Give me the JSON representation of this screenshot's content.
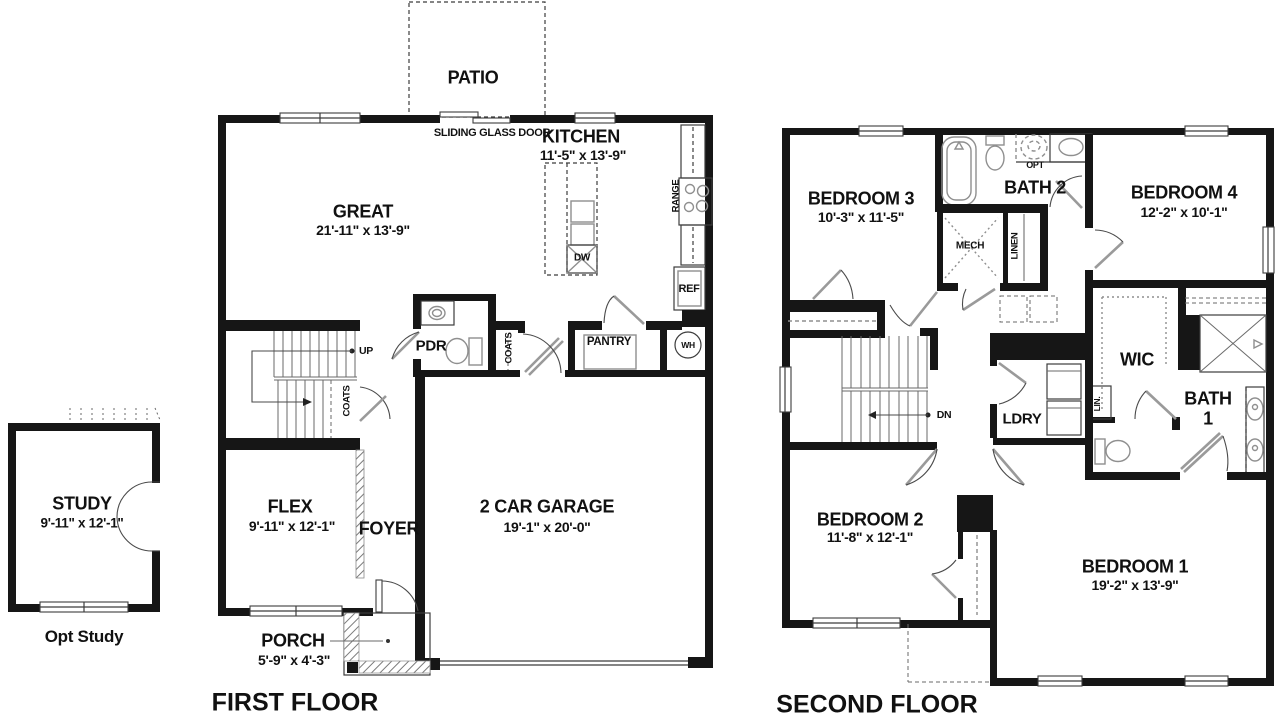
{
  "study": {
    "name": "STUDY",
    "dims": "9'-11\" x 12'-1\"",
    "caption": "Opt Study"
  },
  "first_floor": {
    "title": "FIRST FLOOR",
    "patio": "PATIO",
    "sliding_door": "SLIDING GLASS DOOR",
    "kitchen": {
      "name": "KITCHEN",
      "dims": "11'-5\" x 13'-9\""
    },
    "great": {
      "name": "GREAT",
      "dims": "21'-11\" x 13'-9\""
    },
    "flex": {
      "name": "FLEX",
      "dims": "9'-11\" x 12'-1\""
    },
    "foyer": "FOYER",
    "garage": {
      "name": "2 CAR GARAGE",
      "dims": "19'-1\" x 20'-0\""
    },
    "porch": {
      "name": "PORCH",
      "dims": "5'-9\" x 4'-3\""
    },
    "powder_room": "PDR",
    "pantry": "PANTRY",
    "coats_hall": "COATS",
    "coats_stairs": "COATS",
    "water_heater": "WH",
    "range": "RANGE",
    "dishwasher": "DW",
    "refrigerator": "REF",
    "stairs_up": "UP"
  },
  "second_floor": {
    "title": "SECOND FLOOR",
    "bedroom1": {
      "name": "BEDROOM 1",
      "dims": "19'-2\" x 13'-9\""
    },
    "bedroom2": {
      "name": "BEDROOM 2",
      "dims": "11'-8\" x 12'-1\""
    },
    "bedroom3": {
      "name": "BEDROOM 3",
      "dims": "10'-3\" x 11'-5\""
    },
    "bedroom4": {
      "name": "BEDROOM 4",
      "dims": "12'-2\" x 10'-1\""
    },
    "bath1_line1": "BATH",
    "bath1_line2": "1",
    "bath2": "BATH 2",
    "opt_fixture": "OPT",
    "mech": "MECH",
    "linen": "LINEN",
    "wic": "WIC",
    "laundry": "LDRY",
    "lin_closet": "LIN.",
    "stairs_down": "DN"
  },
  "colors": {
    "wall": "#161616",
    "thin": "#3c3c3c",
    "fixture": "#8f8f8f",
    "text": "#111111",
    "bg": "#ffffff"
  }
}
